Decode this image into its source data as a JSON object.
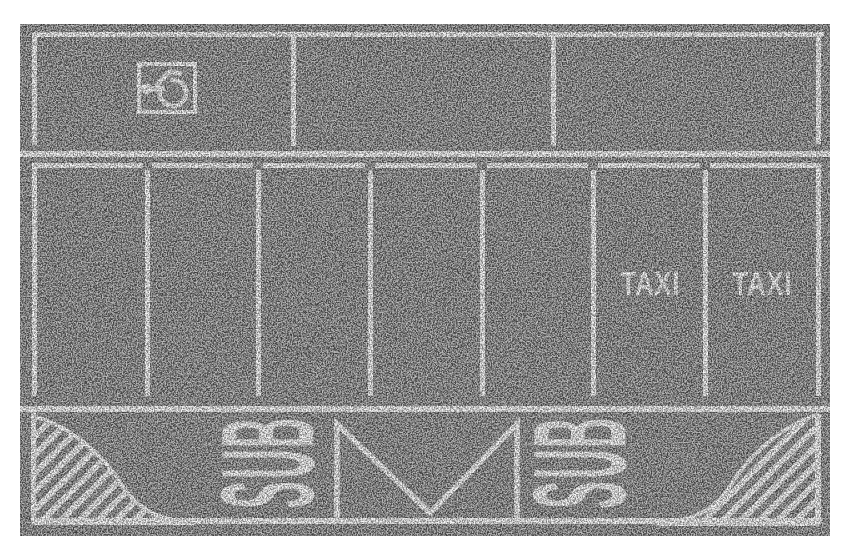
{
  "sheet": {
    "colors": {
      "asphalt": "#7a7a7a",
      "marking_white": "#f2f2f2",
      "paper_white": "#ffffff"
    }
  },
  "markings": {
    "taxi_labels": [
      "TAXI",
      "TAXI"
    ],
    "bus_left": {
      "letters": [
        "B",
        "U",
        "S"
      ]
    },
    "bus_right": {
      "letters": [
        "B",
        "U",
        "S"
      ]
    },
    "accessible_icon": "wheelchair-icon",
    "zigzag_icon": "bus-stop-zigzag-line",
    "hatch_icon": "diagonal-hatch-area"
  }
}
